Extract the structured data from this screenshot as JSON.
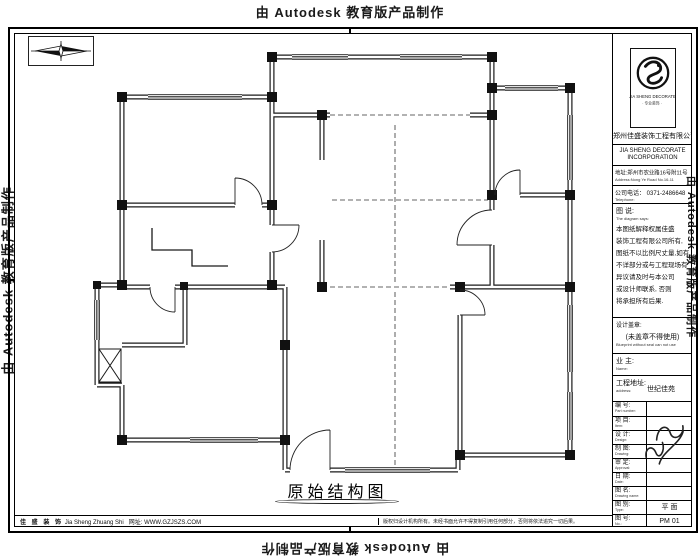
{
  "watermark": {
    "text": "由 Autodesk 教育版产品制作"
  },
  "drawing": {
    "title": "原始结构图"
  },
  "footer": {
    "brand_cn": "佳 盛 装 饰",
    "brand_py": "Jia Sheng Zhuang Shi",
    "website": "网址: WWW.GZJSZS.COM",
    "copyright": "版权归设计机构所有。未经书面允许不得复制引用任何部分，否则将依法追究一切后果。"
  },
  "title_block": {
    "logo": {
      "caption1": "JIA SHENG DECORATE",
      "caption2": "· 专业装饰 ·"
    },
    "company_cn": "郑州佳盛装饰工程有限公司",
    "company_en_line1": "JIA SHENG DECORATE",
    "company_en_line2": "INCORPORATION",
    "address_cn": "地址:郑州市农业路16号附11号",
    "address_en": "Address:Nong Ye Road No.16-11",
    "tel_cn": "公司电话： 0371-2486648",
    "tel_en": "Telephone:",
    "diagram_label_cn": "图 说:",
    "diagram_label_en": "The diagram says:",
    "notice_lines": [
      "本图纸解释权属佳盛",
      "装饰工程有限公司所有,",
      "图纸不以比例尺丈量,如有",
      "不详部分或与工程现场有",
      "异议请及时与本公司",
      "或设计师联系, 否则",
      "将承担所有后果."
    ],
    "stamp_label_cn": "设计盖章:",
    "stamp_note_cn": "(未盖章不得使用)",
    "stamp_note_en": "Blueprint without seal can not use",
    "owner_label_cn": "业 主:",
    "owner_label_en": "Name:",
    "site_label_cn": "工程地址:",
    "site_label_en": "address:",
    "site_value": "世纪佳苑",
    "rows": [
      {
        "label": "编 号:",
        "en": "Part number:",
        "value": ""
      },
      {
        "label": "项 目:",
        "en": "Item:",
        "value": ""
      },
      {
        "label": "设 计:",
        "en": "Design:",
        "value": ""
      },
      {
        "label": "制 图:",
        "en": "Drawing:",
        "value": ""
      },
      {
        "label": "审 定:",
        "en": "Approval:",
        "value": ""
      },
      {
        "label": "日 期:",
        "en": "Date:",
        "value": ""
      },
      {
        "label": "图 名:",
        "en": "Drawing name:",
        "value": ""
      },
      {
        "label": "图 别:",
        "en": "Type:",
        "value": "平 面"
      },
      {
        "label": "图 号:",
        "en": "No.:",
        "value": "PM 01"
      }
    ]
  }
}
